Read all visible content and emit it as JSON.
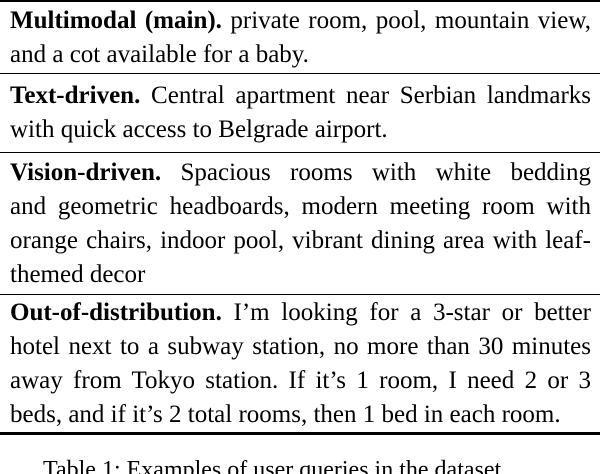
{
  "table": {
    "rows": [
      {
        "label": "Multimodal (main).",
        "lines": [
          " private room, pool, mountain view,",
          "and a cot available for a baby."
        ]
      },
      {
        "label": "Text-driven.",
        "lines": [
          " Central apartment near Serbian landmarks",
          "with quick access to Belgrade airport."
        ]
      },
      {
        "label": "Vision-driven.",
        "lines": [
          " Spacious rooms with white bedding",
          "and geometric headboards, modern meeting room with",
          "orange chairs, indoor pool, vibrant dining area with leaf-",
          "themed decor"
        ]
      },
      {
        "label": "Out-of-distribution.",
        "lines": [
          " I’m looking for a 3-star or better",
          "hotel next to a subway station, no more than 30 minutes",
          "away from Tokyo station.  If it’s 1 room, I need 2 or 3",
          "beds, and if it’s 2 total rooms, then 1 bed in each room."
        ]
      }
    ],
    "caption": "Table 1: Examples of user queries in the dataset."
  },
  "colors": {
    "background": "#ffffff",
    "text": "#000000",
    "rule": "#000000"
  }
}
